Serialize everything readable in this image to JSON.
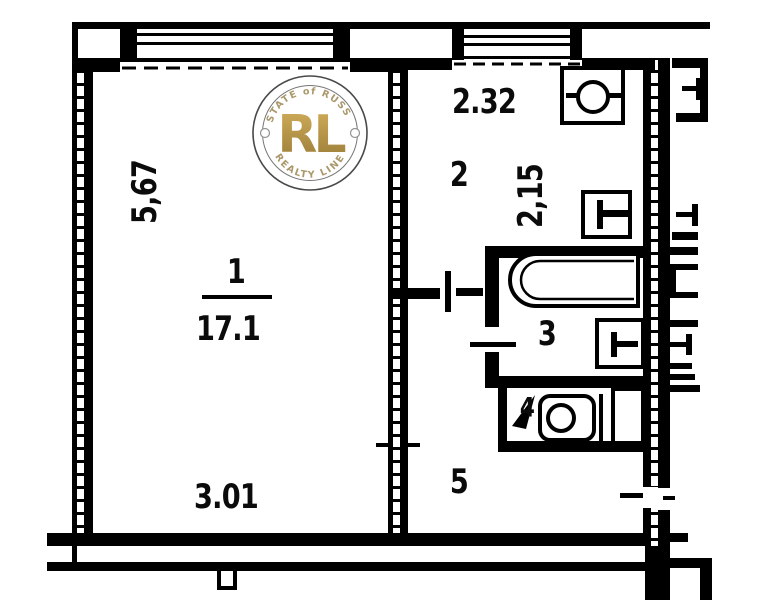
{
  "watermark": {
    "arc_top": "ESTATE of RUSSIA",
    "monogram": "RL",
    "arc_bottom": "REALTY LINE",
    "gold_color": "#b8923c",
    "ring_color": "#3a3a3a"
  },
  "rooms": {
    "living": {
      "number": "1",
      "area": "17.1",
      "width": "3.01",
      "height": "5,67"
    },
    "kitchen": {
      "number": "2",
      "width": "2.32",
      "height": "2,15"
    },
    "bath": {
      "number": "3"
    },
    "wc": {
      "number": "4"
    },
    "hall": {
      "number": "5"
    }
  },
  "palette": {
    "wall": "#000000",
    "background": "#ffffff"
  }
}
